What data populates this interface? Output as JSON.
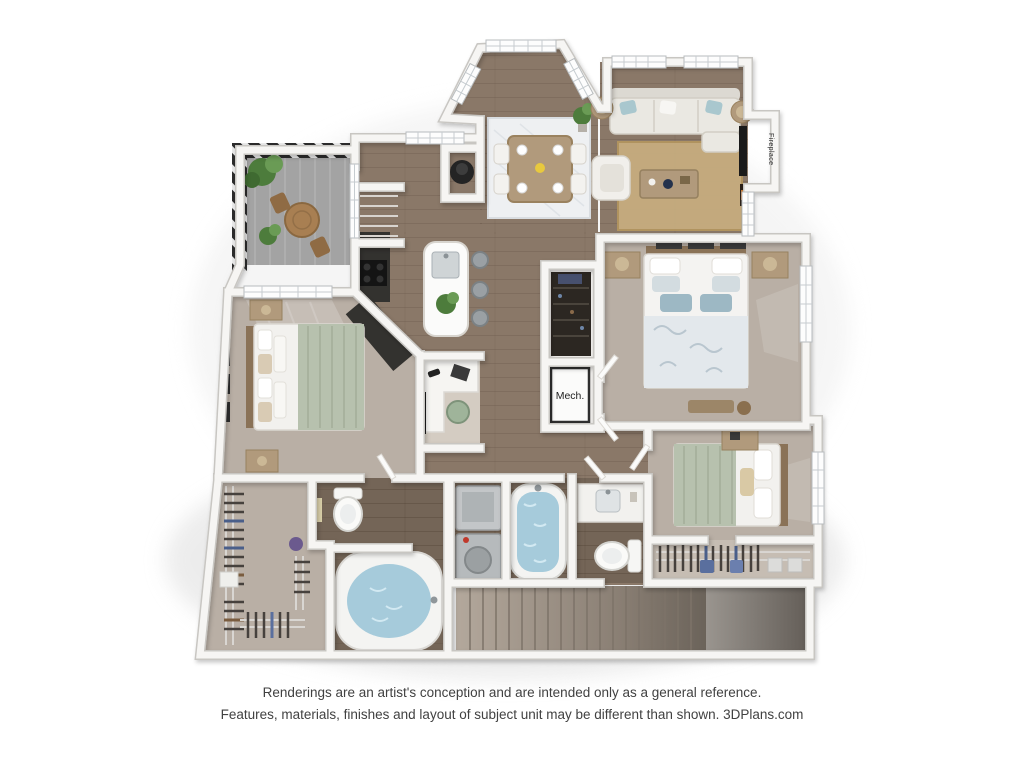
{
  "floorplan": {
    "labels": {
      "mech": "Mech.",
      "fireplace": "Fireplace"
    }
  },
  "footer": {
    "line1": "Renderings are an artist's conception and are intended only as a general reference.",
    "line2": "Features, materials, finishes and layout of subject unit may be different than shown. 3DPlans.com"
  },
  "palette": {
    "background": "#ffffff",
    "wood": "#8a7868",
    "wood_dark": "#746557",
    "carpet": "#b9afa5",
    "carpet_light": "#c6bdb3",
    "balcony": "#a3a3a3",
    "railing": "#2c2c2c",
    "rug_living": "#c5ab7e",
    "rug_dining": "#eef0f2",
    "sofa": "#eae8e2",
    "accent_pillow": "#a9c7ce",
    "sage": "#b7c1ae",
    "duvet": "#e3e8ec",
    "water": "#a6cbdb",
    "furniture_wood": "#b19a7c",
    "appliance_dark": "#2b2b2b",
    "stairs_light": "#b3a89c",
    "stairs_dark": "#57504a",
    "text": "#414141"
  }
}
